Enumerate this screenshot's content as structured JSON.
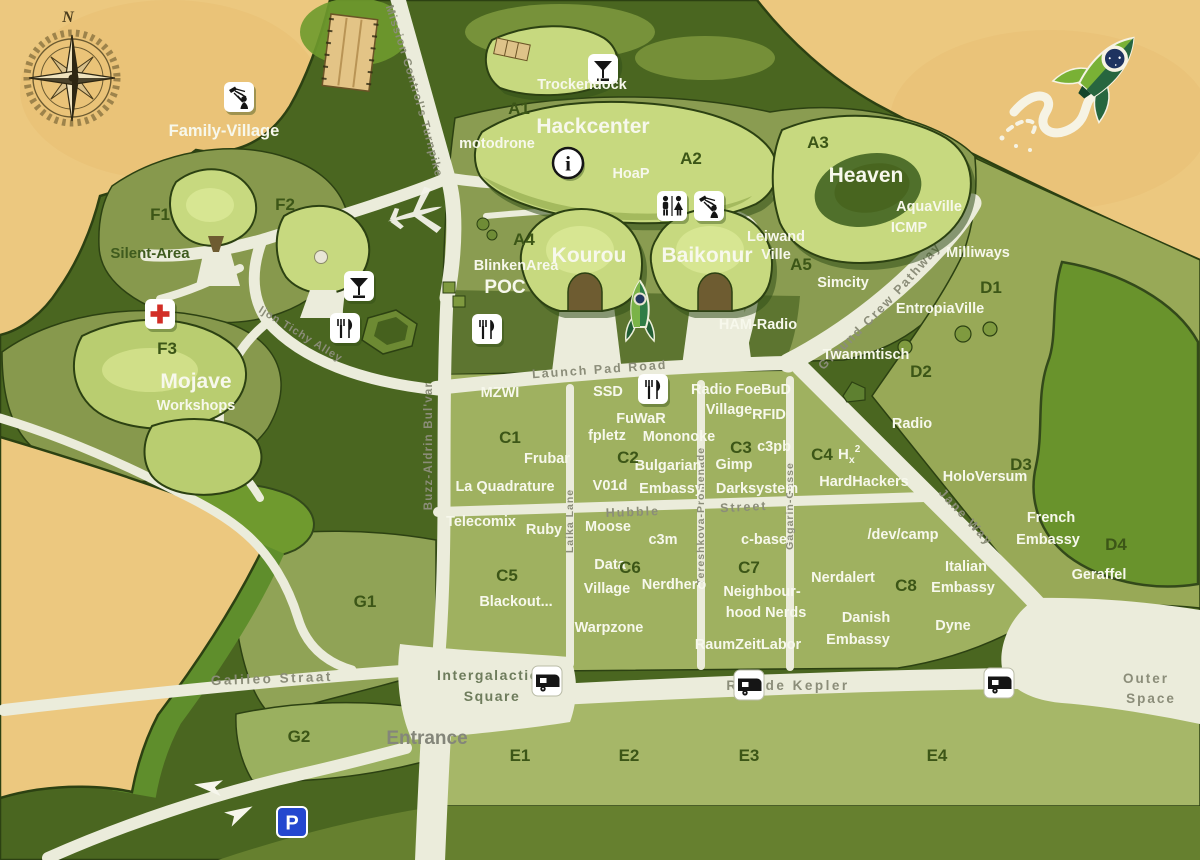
{
  "title": "Camp site map",
  "palette": {
    "sand": "#ecc87f",
    "forest": "#4a6620",
    "field": "#8a9c51",
    "c_field": "#9fb160",
    "d_field": "#98a957",
    "e_strip": "#a6b768",
    "bright_green": "#69932c",
    "tent_light": "#c7d97f",
    "road": "#ebecdb",
    "road_label": "#8b8d79",
    "label_white": "#f7f8ec",
    "label_dark_green": "#3c5617",
    "parking_blue": "#2447cf",
    "firstaid_red": "#d22d26"
  },
  "compass": {
    "north": "N"
  },
  "roads": {
    "turnpike": "Mission Control's Turnpike",
    "ijon": "Ijon Tichy Alley",
    "buzz": "Buzz-Aldrin Bul'var",
    "launch_pad": "Launch Pad Road",
    "ground_crew": "Ground Crew Pathway",
    "jane": "Jane Way",
    "hubble_1": "Hubble",
    "hubble_2": "Street",
    "laika": "Laika Lane",
    "tereshkova": "Tereshkova-Promenade",
    "gagarin": "Gagarin-Gasse",
    "galileo": "Galileo Straat",
    "kepler": "Rue de Kepler"
  },
  "signs": {
    "entrance": "Entrance",
    "intergalactic_1": "Intergalactic",
    "intergalactic_2": "Square",
    "outer_1": "Outer",
    "outer_2": "Space",
    "parking": "P",
    "info": "i"
  },
  "blocks": {
    "a1": "A1",
    "a2": "A2",
    "a3": "A3",
    "a4": "A4",
    "a5": "A5",
    "c1": "C1",
    "c2": "C2",
    "c3": "C3",
    "c4": "C4",
    "c5": "C5",
    "c6": "C6",
    "c7": "C7",
    "c8": "C8",
    "d1": "D1",
    "d2": "D2",
    "d3": "D3",
    "d4": "D4",
    "e1": "E1",
    "e2": "E2",
    "e3": "E3",
    "e4": "E4",
    "f1": "F1",
    "f2": "F2",
    "f3": "F3",
    "g1": "G1",
    "g2": "G2"
  },
  "places": {
    "family_village": "Family-Village",
    "silent_area": "Silent-Area",
    "mojave": "Mojave",
    "workshops": "Workshops",
    "trockendock": "Trockendock",
    "hackcenter": "Hackcenter",
    "motodrone": "motodrone",
    "hoap": "HoaP",
    "heaven": "Heaven",
    "aquaville": "AquaVille",
    "icmp": "ICMP",
    "milliways": "Milliways",
    "leiwand_1": "Leiwand",
    "leiwand_2": "Ville",
    "simcity": "Simcity",
    "ham_radio": "HAM-Radio",
    "entropiaville": "EntropiaVille",
    "twammtisch": "Twammtisch",
    "radio": "Radio",
    "holoversum": "HoloVersum",
    "blinkenarea": "BlinkenArea",
    "poc": "POC",
    "kourou": "Kourou",
    "baikonur": "Baikonur",
    "mzwi": "MZWI",
    "frubar": "Frubar",
    "la_quadrature": "La Quadrature",
    "ssd": "SSD",
    "fuwar": "FuWaR",
    "fpletz": "fpletz",
    "mononoke": "Mononoke",
    "bulgarian_1": "Bulgarian",
    "bulgarian_2": "Embassy",
    "v01d": "V01d",
    "foebud_1": "Radio FoeBuD",
    "foebud_2": "Village",
    "rfid": "RFID",
    "c3pb": "c3pb",
    "gimp": "Gimp",
    "darksystem": "Darksystem",
    "hx_h": "H",
    "hx_x": "x",
    "hx_exp": "2",
    "hardhackers": "HardHackers",
    "telecomix": "Telecomix",
    "ruby": "Ruby",
    "moose": "Moose",
    "c3m": "c3m",
    "c_base": "c-base",
    "blackout": "Blackout...",
    "data_1": "Data",
    "data_2": "Village",
    "nerdhero": "Nerdhero",
    "warpzone": "Warpzone",
    "neighbourhood_1": "Neighbour-",
    "neighbourhood_2": "hood Nerds",
    "raumzeitlabor": "RaumZeitLabor",
    "devcamp": "/dev/camp",
    "nerdalert": "Nerdalert",
    "danish_1": "Danish",
    "danish_2": "Embassy",
    "dyne": "Dyne",
    "italian_1": "Italian",
    "italian_2": "Embassy",
    "french_1": "French",
    "french_2": "Embassy",
    "geraffel": "Geraffel"
  },
  "icons": [
    "shower",
    "cocktail",
    "info",
    "wc",
    "restaurant",
    "first-aid",
    "caravan",
    "parking",
    "compass-rose",
    "rocket-logo",
    "rocket-statue",
    "airplane",
    "arrow"
  ]
}
